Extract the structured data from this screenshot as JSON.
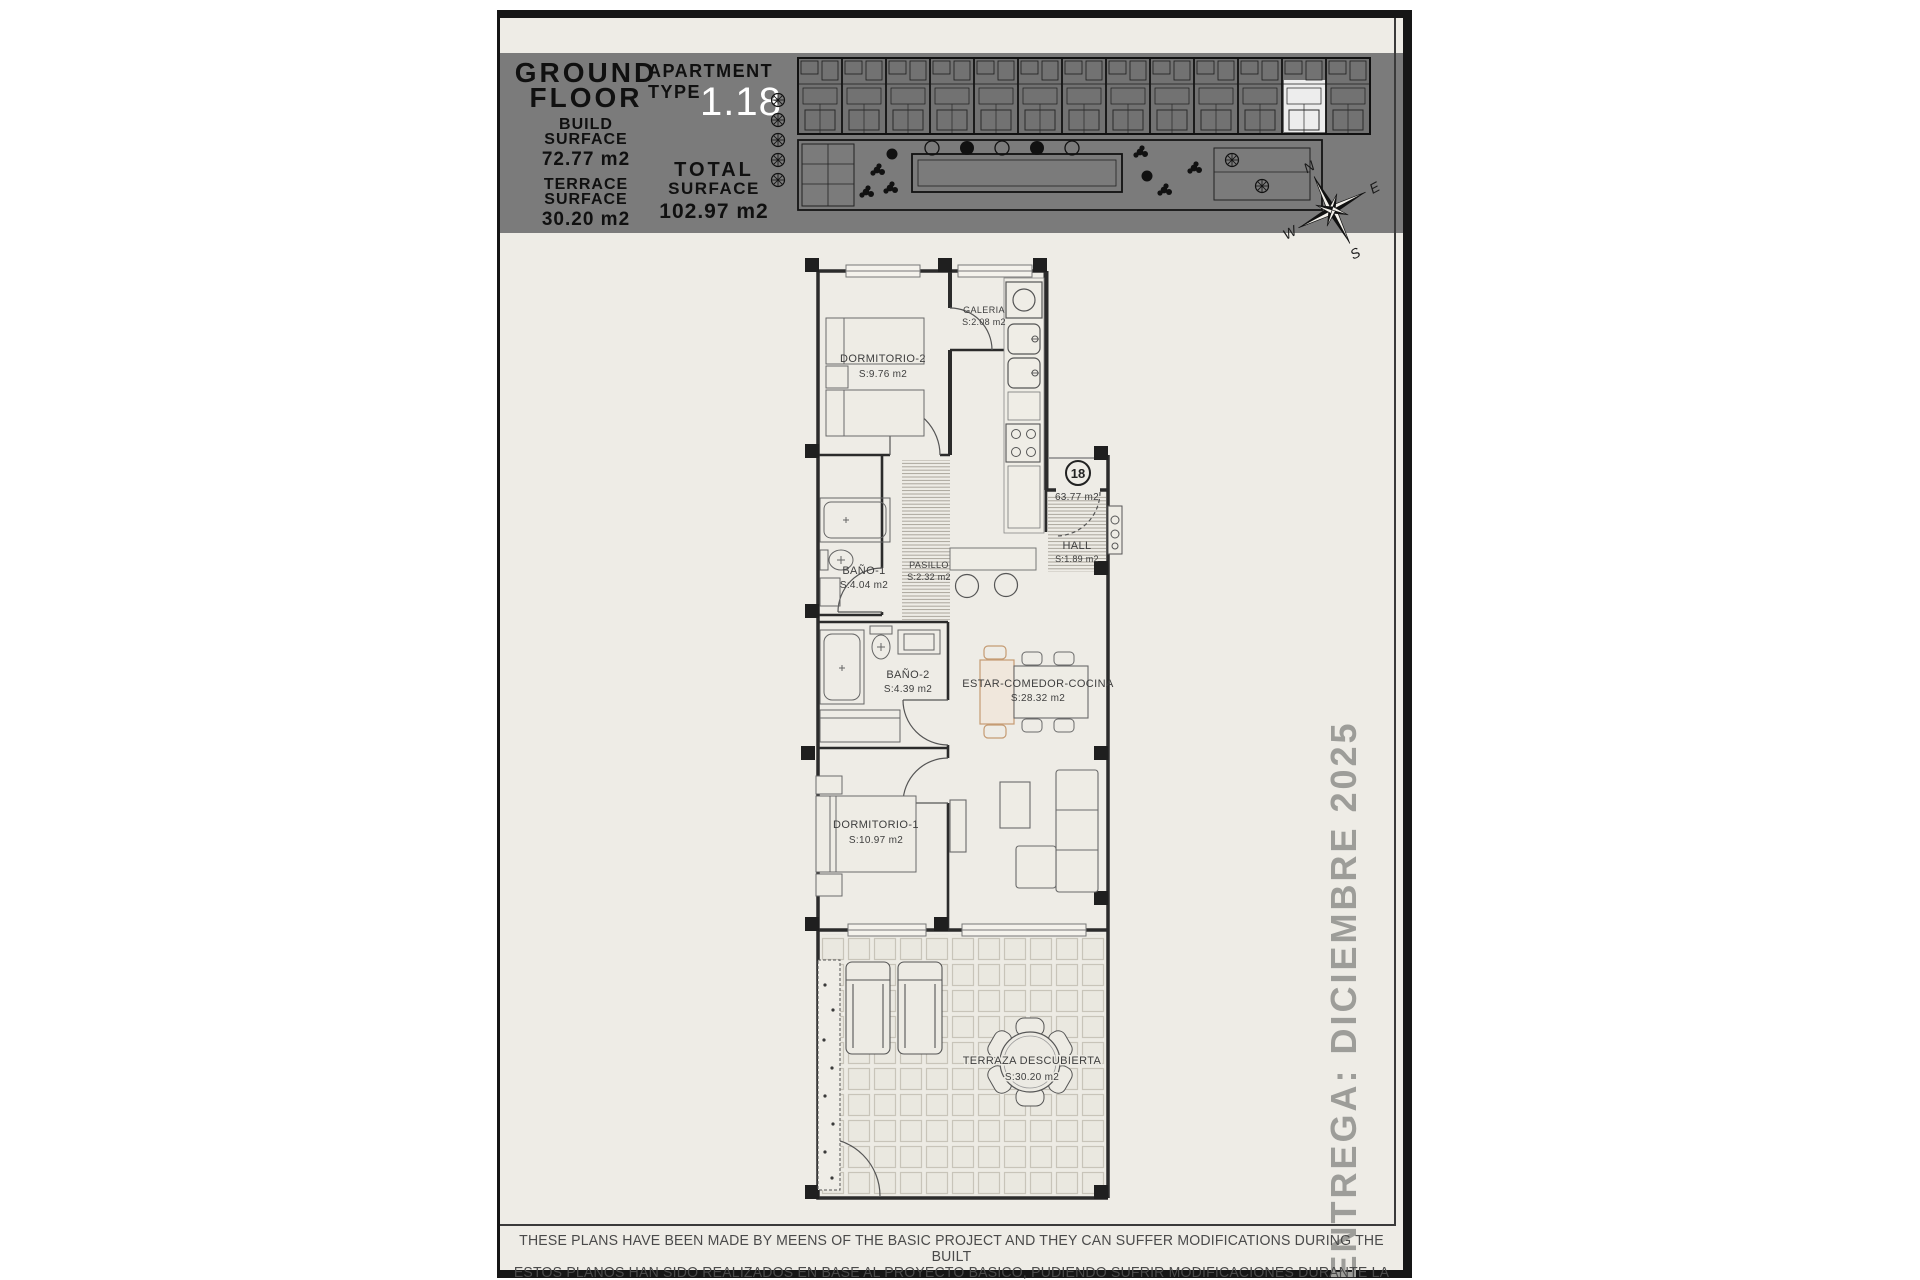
{
  "colors": {
    "paper": "#eeece6",
    "header_band": "#7b7b7b",
    "frame": "#161616",
    "highlight_unit": "#ffffff",
    "apartment_number_text": "#ffffff",
    "tan_accent": "#c59b73",
    "side_note_gray": "#9d9d99"
  },
  "header": {
    "title_line1": "GROUND",
    "title_line2": "FLOOR",
    "build": {
      "label_line1": "BUILD",
      "label_line2": "SURFACE",
      "value": "72.77 m2"
    },
    "terrace": {
      "label_line1": "TERRACE",
      "label_line2": "SURFACE",
      "value": "30.20 m2"
    },
    "apartment": {
      "label_line1": "APARTMENT",
      "label_line2": "TYPE",
      "number": "1.18"
    },
    "total": {
      "label_line1": "TOTAL",
      "label_line2": "SURFACE",
      "value": "102.97 m2"
    }
  },
  "compass": {
    "n": "N",
    "e": "E",
    "s": "S",
    "w": "W"
  },
  "plan": {
    "rooms": [
      {
        "name": "DORMITORIO-2",
        "area": "S:9.76 m2"
      },
      {
        "name": "GALERIA",
        "area": "S:2.08 m2"
      },
      {
        "name": "BAÑO-1",
        "area": "S:4.04 m2"
      },
      {
        "name": "PASILLO",
        "area": "S:2.32 m2"
      },
      {
        "name": "HALL",
        "area": "S:1.89 m2"
      },
      {
        "name": "BAÑO-2",
        "area": "S:4.39 m2"
      },
      {
        "name": "ESTAR-COMEDOR-COCINA",
        "area": "S:28.32 m2"
      },
      {
        "name": "DORMITORIO-1",
        "area": "S:10.97 m2"
      },
      {
        "name": "TERRAZA DESCUBIERTA",
        "area": "S:30.20 m2"
      }
    ],
    "entrance": {
      "unit_number": "18",
      "area": "63.77 m2"
    }
  },
  "side_note": "ENTREGA: DICIEMBRE 2025",
  "footer": {
    "line1": "THESE PLANS HAVE BEEN MADE BY MEENS OF THE BASIC PROJECT AND THEY CAN SUFFER MODIFICATIONS DURING THE BUILT",
    "line2": "ESTOS PLANOS HAN SIDO REALIZADOS EN BASE AL PROYECTO BASICO, PUDIENDO SUFRIR MODIFICACIONES DURANTE LA EJECUCION"
  }
}
